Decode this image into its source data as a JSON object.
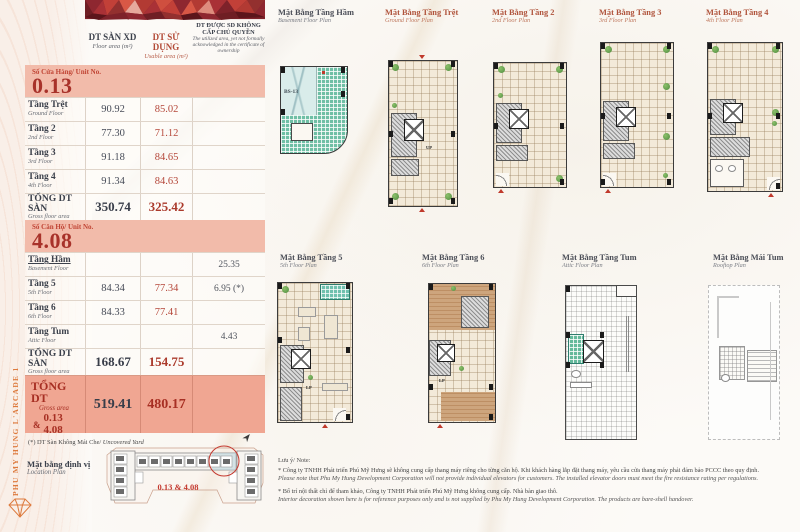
{
  "sidebar": {
    "vertical_text": "PHU MY HUNG L'ARCADE 1"
  },
  "colors": {
    "accent_orange": "#dd7a3d",
    "accent_red": "#b5473a",
    "dark_text": "#3b404b",
    "band_pink": "#f2bbaa",
    "band_pink_dark": "#f0a692",
    "banner_reds": [
      "#6f1e24",
      "#8e2730",
      "#c24038",
      "#d85846",
      "#e7a99c"
    ],
    "plan_beige": "#f3ead9",
    "plan_teal": "#6fc0ae",
    "plan_wood": "#cda57d"
  },
  "table": {
    "headers": {
      "xd_vn": "DT SÀN XD",
      "xd_en": "Floor area (m²)",
      "sd_vn": "DT SỬ DỤNG",
      "sd_en": "Usable area (m²)",
      "ex_vn": "DT ĐƯỢC SD KHÔNG CẤP CHỦ QUYỀN",
      "ex_en": "The utilized area, yet not formally acknowledged in the certificate of ownership"
    },
    "unit1": {
      "label": "Số Cửa Hàng/ Unit No.",
      "number": "0.13"
    },
    "section1": {
      "rows": [
        {
          "vn": "Tầng Trệt",
          "en": "Ground Floor",
          "xd": "90.92",
          "sd": "85.02",
          "ex": ""
        },
        {
          "vn": "Tầng 2",
          "en": "2nd Floor",
          "xd": "77.30",
          "sd": "71.12",
          "ex": ""
        },
        {
          "vn": "Tầng 3",
          "en": "3rd Floor",
          "xd": "91.18",
          "sd": "84.65",
          "ex": ""
        },
        {
          "vn": "Tầng 4",
          "en": "4th Floor",
          "xd": "91.34",
          "sd": "84.63",
          "ex": ""
        }
      ],
      "total": {
        "vn": "TỔNG DT SÀN",
        "en": "Gross floor area",
        "xd": "350.74",
        "sd": "325.42",
        "ex": ""
      }
    },
    "unit2": {
      "label": "Số Căn Hộ/ Unit No.",
      "number": "4.08"
    },
    "section2": {
      "rows": [
        {
          "vn": "Tầng Hầm",
          "en": "Basement Floor",
          "xd": "",
          "sd": "",
          "ex": "25.35"
        },
        {
          "vn": "Tầng 5",
          "en": "5th Floor",
          "xd": "84.34",
          "sd": "77.34",
          "ex": "6.95 (*)"
        },
        {
          "vn": "Tầng 6",
          "en": "6th Floor",
          "xd": "84.33",
          "sd": "77.41",
          "ex": ""
        },
        {
          "vn": "Tầng Tum",
          "en": "Attic Floor",
          "xd": "",
          "sd": "",
          "ex": "4.43"
        }
      ],
      "total": {
        "vn": "TỔNG DT SÀN",
        "en": "Gross floor area",
        "xd": "168.67",
        "sd": "154.75",
        "ex": ""
      }
    },
    "grand": {
      "vn": "TỔNG DT",
      "en": "Gross area",
      "amp": "&",
      "unit_a": "0.13",
      "unit_b": "4.08",
      "xd": "519.41",
      "sd": "480.17"
    },
    "footnote_vn": "(*) DT Sàn Không Mái Che/",
    "footnote_en": " Uncovered Yard"
  },
  "location": {
    "label_vn": "Mặt bằng định vị",
    "label_en": "Location Plan",
    "unit_label": "0.13 & 4.08"
  },
  "plans_row1": [
    {
      "vn": "Mặt Bằng Tầng Hầm",
      "en": "Basement Floor Plan",
      "ramp_label": "BS-13"
    },
    {
      "vn": "Mặt Bằng Tầng Trệt",
      "en": "Ground Floor Plan",
      "stair_label": "UP"
    },
    {
      "vn": "Mặt Bằng Tầng 2",
      "en": "2nd Floor Plan"
    },
    {
      "vn": "Mặt Bằng Tầng 3",
      "en": "3rd Floor Plan"
    },
    {
      "vn": "Mặt Bằng Tầng 4",
      "en": "4th Floor Plan"
    }
  ],
  "plans_row2": [
    {
      "vn": "Mặt Bằng Tầng 5",
      "en": "5th Floor Plan",
      "stair_label": "LP"
    },
    {
      "vn": "Mặt Bằng Tầng 6",
      "en": "6th Floor Plan",
      "stair_label": "LP"
    },
    {
      "vn": "Mặt Bằng Tầng Tum",
      "en": "Attic Floor Plan"
    },
    {
      "vn": "Mặt Bằng Mái Tum",
      "en": "Rooftop Plan"
    }
  ],
  "notes": {
    "heading": "Lưu ý/ Note:",
    "n1_vn": "* Công ty TNHH Phát triển Phú Mỹ Hưng sẽ không cung cấp thang máy riêng cho từng căn hộ. Khi khách hàng lắp đặt thang máy, yêu cầu cửa thang máy phải đảm bảo PCCC theo quy định.",
    "n1_en": "Please note that Phu My Hung Development Corporation will not provide individual elevators for customers. The installed elevator doors must meet the fire resistance rating per regulations.",
    "n2_vn": "* Bố trí nội thất chỉ để tham khảo, Công ty TNHH Phát triển Phú Mỹ Hưng không cung cấp. Nhà bàn giao thô.",
    "n2_en": "Interior decoration shown here is for reference purposes only and is not supplied by Phu My Hung Development Corporation. The products are bare-shell handover."
  }
}
